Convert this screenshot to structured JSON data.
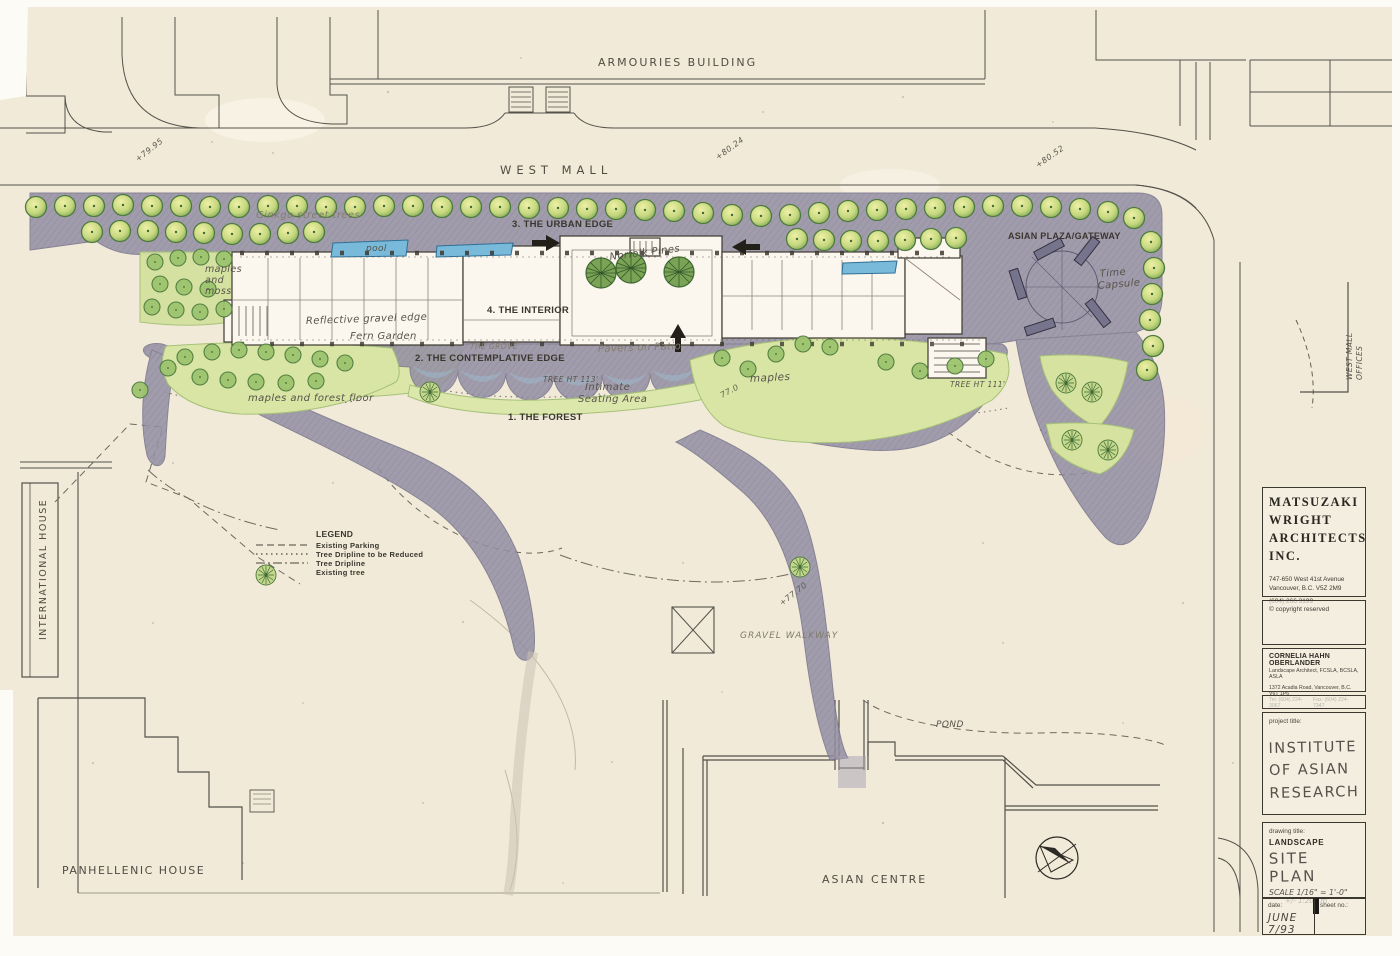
{
  "sheet": {
    "site": {
      "armouries": "ARMOURIES BUILDING",
      "west_mall": "WEST MALL",
      "international_house": "INTERNATIONAL HOUSE",
      "panhellenic_house": "PANHELLENIC HOUSE",
      "asian_centre": "ASIAN CENTRE",
      "west_mall_offices": [
        "WEST MALL",
        "OFFICES"
      ],
      "pond": "POND",
      "gravel_walkway": "GRAVEL WALKWAY"
    },
    "landscape": {
      "ginkgo": "Ginkgo street trees",
      "urban_edge": "3. THE URBAN EDGE",
      "pool": "pool",
      "maples_moss": [
        "maples",
        "and",
        "moss"
      ],
      "interior": "4. THE INTERIOR",
      "reflective_gravel_edge": "Reflective gravel edge",
      "fern_garden": "Fern Garden",
      "the_grove": "THE GROVE",
      "contemplative_edge": "2. THE CONTEMPLATIVE EDGE",
      "pavers_on_patio": "Pavers on Patio",
      "norfolk_pines": "Norfolk Pines",
      "tree_ht_113": "TREE HT 113'",
      "intimate_seating": [
        "Intimate",
        "Seating Area"
      ],
      "forest": "1. THE FOREST",
      "maples": "maples",
      "maples_forest_floor": "maples and forest floor",
      "asian_plaza": "ASIAN PLAZA/GATEWAY",
      "time_capsule": [
        "Time",
        "Capsule"
      ],
      "tree_ht_111": "TREE HT 111'"
    },
    "spots": {
      "s1": "+79.95",
      "s2": "+80.24",
      "s3": "+80.52",
      "s4": "77.0",
      "s5": "+77.70"
    },
    "legend": {
      "title": "LEGEND",
      "items": [
        {
          "label": "Existing Parking",
          "style": "dashed"
        },
        {
          "label": "Tree Dripline to be Reduced",
          "style": "dotted"
        },
        {
          "label": "Tree Dripline",
          "style": "dashdot"
        },
        {
          "label": "Existing tree",
          "style": "tree-symbol"
        }
      ]
    }
  },
  "title_block": {
    "firm": {
      "name_lines": [
        "MATSUZAKI",
        "WRIGHT",
        "ARCHITECTS",
        "INC."
      ],
      "address_lines": [
        "747-650 West 41st Avenue",
        "Vancouver, B.C.  V5Z 2M9"
      ],
      "phone": "(604) 266 3199"
    },
    "copyright": "© copyright reserved",
    "landscape_architect": {
      "name": "CORNELIA HAHN OBERLANDER",
      "title": "Landscape Architect, FCSLA, BCSLA, ASLA",
      "address": "1372 Acadia Road, Vancouver, B.C. V6T 1P6",
      "tel": "Tel: (604) 224-3067",
      "fax": "Fax: (604) 224-7347"
    },
    "project": {
      "label": "project title:",
      "lines": [
        "INSTITUTE",
        "OF ASIAN",
        "RESEARCH"
      ]
    },
    "drawing": {
      "label": "drawing title:",
      "series": "LANDSCAPE",
      "title": "SITE PLAN",
      "scale1": "SCALE 1/16\" = 1'-0\"",
      "scale2": "+/- 1:200 m"
    },
    "date": {
      "label": "date:",
      "value": "JUNE 7/93"
    },
    "sheet_no": {
      "label": "sheet no.:"
    }
  },
  "colors": {
    "paper": "#f1ead9",
    "plaza": "#948fa4",
    "lawn": "#d6e2a0",
    "tree": "#a9c869",
    "pool": "#74b6d8",
    "ink": "#4a463c"
  }
}
